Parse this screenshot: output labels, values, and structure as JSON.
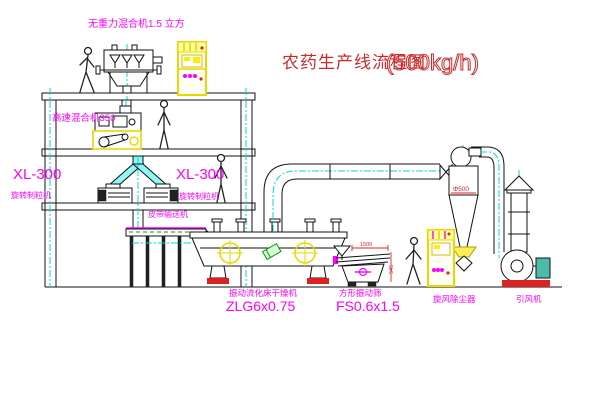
{
  "title": {
    "main": "农药生产线流程图",
    "capacity": "(500kg/h)"
  },
  "labels": {
    "gravity_mixer": "无重力混合机1.5 立方",
    "high_speed_mixer": "高速混合机350",
    "xl300_left": "XL-300",
    "granulator_left": "旋转制粒机",
    "xl300_right": "XL-300",
    "granulator_right": "旋转制粒机",
    "belt_conveyor": "皮带输送机",
    "dryer": "振动流化床干燥机",
    "dryer_model": "ZLG6x0.75",
    "screen": "方形振动筛",
    "screen_model": "FS0.6x1.5",
    "cyclone": "旋风除尘器",
    "fan": "引风机"
  },
  "dimensions": {
    "cyclone_diameter": "Φ500",
    "screen_width": "1500",
    "screen_height": "545"
  },
  "colors": {
    "label_magenta": "#ff00ff",
    "title_red": "#cc2a2a",
    "cabinet_yellow": "#e6d800",
    "centerline_cyan": "#00d8d8",
    "accent_green": "#00a000",
    "base_red": "#dd2222",
    "line_black": "#111111"
  }
}
